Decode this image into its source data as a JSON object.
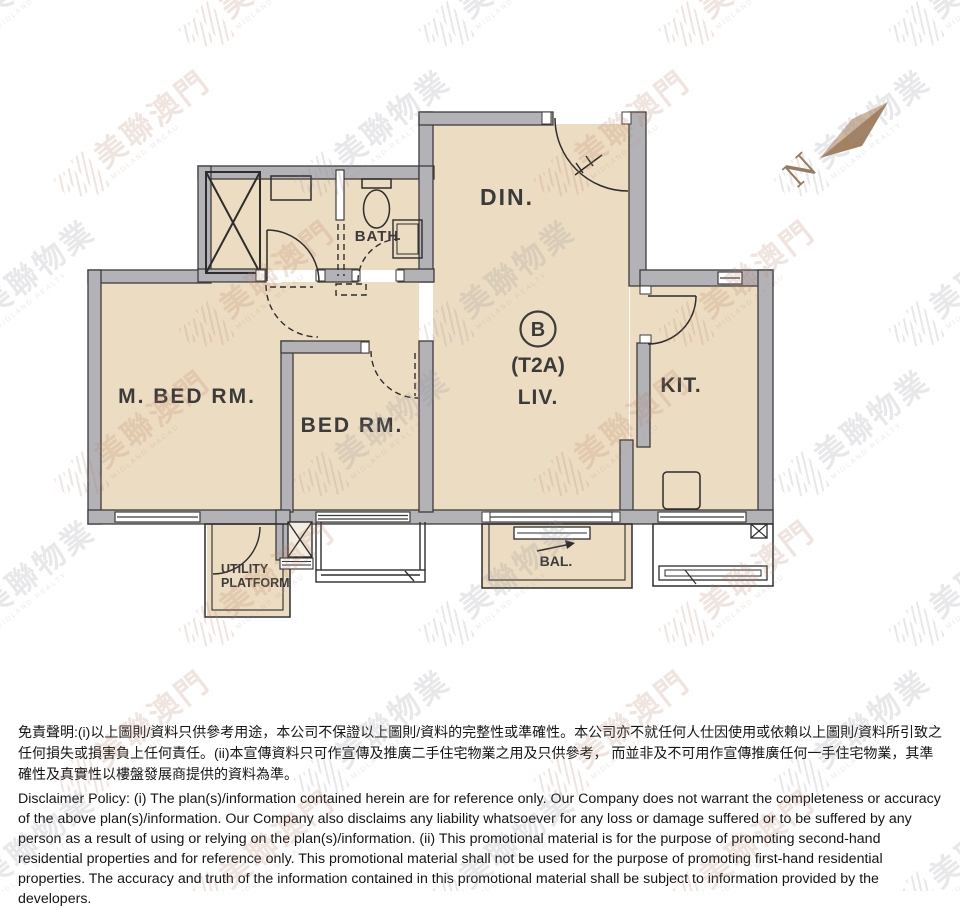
{
  "plan": {
    "labels": {
      "dining": "DIN.",
      "bath": "BATH",
      "master_bedroom": "M. BED RM.",
      "bedroom": "BED RM.",
      "unit": "B",
      "unit_type": "(T2A)",
      "living": "LIV.",
      "kitchen": "KIT.",
      "balcony": "BAL.",
      "utility_platform_line1": "UTILITY",
      "utility_platform_line2": "PLATFORM",
      "compass": "N"
    },
    "colors": {
      "room_fill": "#ecdcc1",
      "wall_fill": "#b3b3b7",
      "line": "#2d2d2d",
      "compass_light": "#cfb79f",
      "compass_dark": "#a5805f"
    }
  },
  "watermark": {
    "realty_zh": "美聯物業",
    "realty_en": "MIDLAND REALTY",
    "macau_zh": "美聯澳門",
    "macau_en": "MIDLAND MACAU",
    "gray_color": "#8f8f99",
    "tan_color": "#bc8468"
  },
  "disclaimer": {
    "chinese": "免責聲明:(i)以上圖則/資料只供參考用途，本公司不保證以上圖則/資料的完整性或準確性。本公司亦不就任何人仕因使用或依賴以上圖則/資料所引致之任何損失或損害負上任何責任。(ii)本宣傳資料只可作宣傳及推廣二手住宅物業之用及只供參考， 而並非及不可用作宣傳推廣任何一手住宅物業，其準確性及真實性以樓盤發展商提供的資料為準。",
    "english": "Disclaimer Policy: (i) The plan(s)/information contained herein are for reference only. Our Company does not warrant the completeness or accuracy of the above plan(s)/information. Our Company also disclaims any liability whatsoever for any loss or damage suffered or to be suffered by any person as a result of using or relying on the plan(s)/information. (ii) This promotional material is for the purpose of promoting second-hand residential properties and for reference only. This promotional material shall not be used for the purpose of promoting first-hand residential properties. The accuracy and truth of the information contained in this promotional material shall be subject to information provided by the developers."
  }
}
